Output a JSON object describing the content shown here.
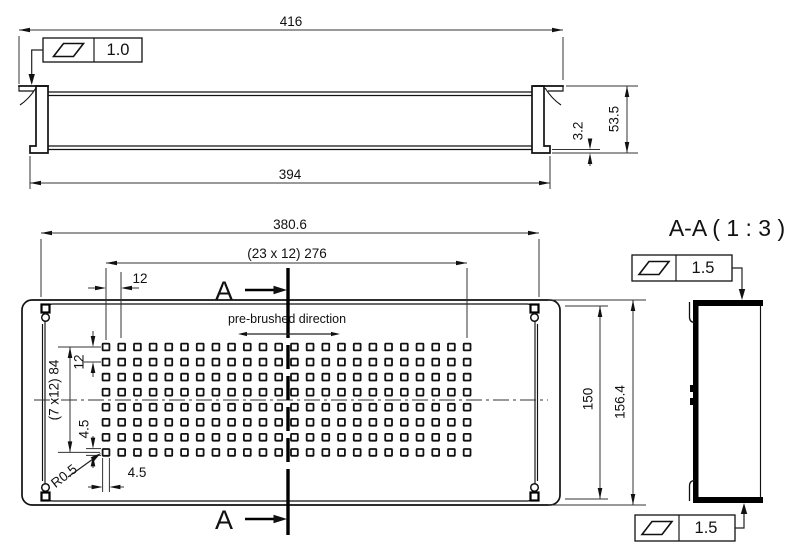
{
  "side_view": {
    "dim_overall_width": "416",
    "dim_inner_width": "394",
    "dim_height": "53.5",
    "dim_flange": "3.2",
    "flatness_value": "1.0"
  },
  "front_view": {
    "dim_overall_width": "380.6",
    "dim_hole_span": "(23  x 12) 276",
    "dim_hole_pitch": "12",
    "dim_row_span": "(7 x12) 84",
    "dim_row_pitch": "12",
    "dim_hole_height": "4.5",
    "dim_hole_width": "4.5",
    "dim_corner_radius": "R0.5",
    "dim_inner_height": "150",
    "dim_overall_height": "156.4",
    "section_label_top": "A",
    "section_label_bottom": "A",
    "note_brush": "pre-brushed direction",
    "holes": {
      "cols": 24,
      "rows": 8,
      "start_x": 106,
      "start_y": 347,
      "pitch_x": 15.7,
      "pitch_y": 15.05,
      "size": 6.8
    }
  },
  "section_view": {
    "title": "A-A ( 1 : 3 )",
    "flatness_top": "1.5",
    "flatness_bottom": "1.5"
  }
}
